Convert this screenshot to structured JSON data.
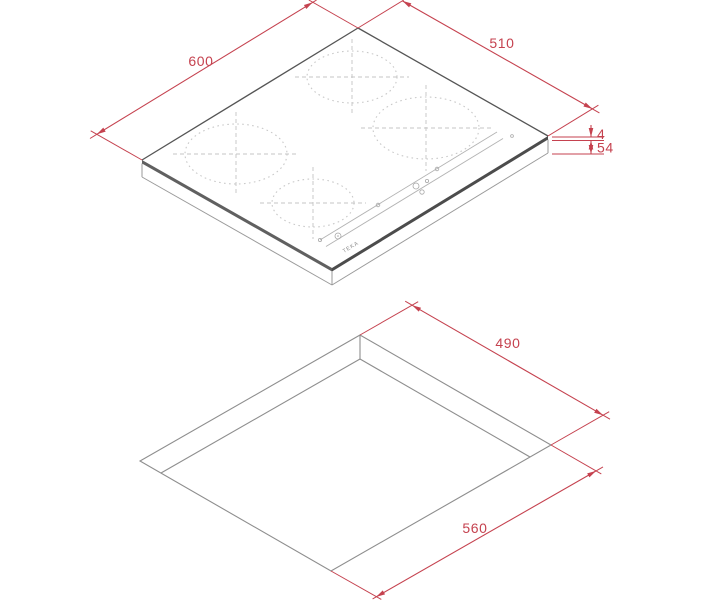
{
  "drawing": {
    "type": "product-dimension-diagram",
    "background_color": "#ffffff",
    "dimension_color": "#c5424f",
    "outline_color": "#555555",
    "cutout_line_color": "#8e8e8e",
    "hob_view": {
      "description": "isometric view of 4-zone induction hob",
      "width_label": "600",
      "depth_label": "510",
      "glass_thickness_label": "4",
      "body_height_label": "54",
      "brand_label": "TEKA",
      "cooking_zone_count": 4
    },
    "cutout_view": {
      "description": "isometric view of worktop cutout",
      "depth_label": "490",
      "width_label": "560"
    }
  }
}
